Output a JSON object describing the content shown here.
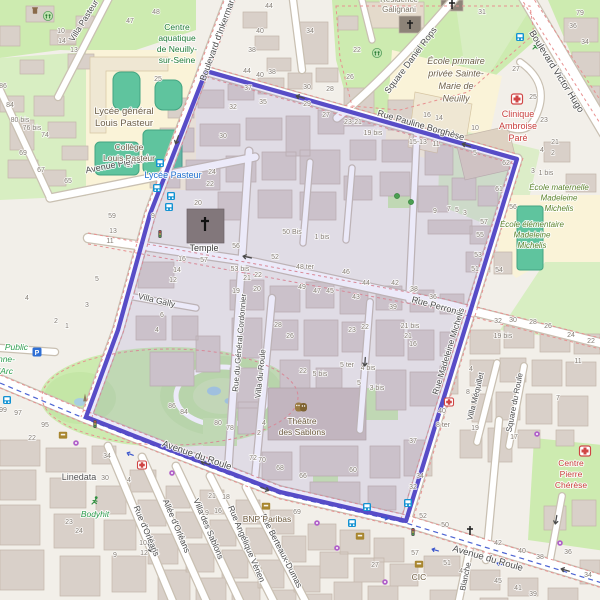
{
  "colors": {
    "boundary": "#4f43c4",
    "boundary_fill": "#6a5ad0",
    "road": "#ffffff",
    "park_green": "#cdebb0",
    "building": "#d9d0c9",
    "pitch_teal": "#5fc49e",
    "hospital_text": "#c9403e",
    "transit_text": "#1f6fd0"
  },
  "streets": [
    {
      "name": "Villa Pasteur",
      "x": 86,
      "y": 22,
      "rot": -58,
      "size": 8.5
    },
    {
      "name": "Boulevard d'Inkermann",
      "x": 221,
      "y": 38,
      "rot": -70,
      "size": 9
    },
    {
      "name": "Avenue Pierrard",
      "x": 118,
      "y": 167,
      "rot": -11,
      "size": 9
    },
    {
      "name": "Rue Pauline Borghèse",
      "x": 420,
      "y": 128,
      "rot": 16,
      "size": 9
    },
    {
      "name": "Square Daniel Rops",
      "x": 413,
      "y": 62,
      "rot": -53,
      "size": 9
    },
    {
      "name": "Boulevard Victor Hugo",
      "x": 554,
      "y": 73,
      "rot": 58,
      "size": 9.5
    },
    {
      "name": "Villa Gally",
      "x": 156,
      "y": 303,
      "rot": 13,
      "size": 8.5
    },
    {
      "name": "Rue du Général Cordonnier",
      "x": 242,
      "y": 343,
      "rot": -85,
      "size": 8
    },
    {
      "name": "Villa du Roule",
      "x": 263,
      "y": 374,
      "rot": -84,
      "size": 8
    },
    {
      "name": "Rue Perronet",
      "x": 437,
      "y": 309,
      "rot": 15,
      "size": 9
    },
    {
      "name": "Rue Madeleine Michelis",
      "x": 451,
      "y": 352,
      "rot": -73,
      "size": 8.5
    },
    {
      "name": "Villa Méquillet",
      "x": 478,
      "y": 397,
      "rot": -76,
      "size": 8
    },
    {
      "name": "Square du Roule",
      "x": 517,
      "y": 403,
      "rot": -79,
      "size": 8
    },
    {
      "name": "Avenue du Roule",
      "x": 196,
      "y": 458,
      "rot": 19,
      "size": 9.5
    },
    {
      "name": "Avenue du Roule",
      "x": 487,
      "y": 561,
      "rot": 16,
      "size": 9.5
    },
    {
      "name": "Rue d'Orléans",
      "x": 144,
      "y": 532,
      "rot": 67,
      "size": 8.5
    },
    {
      "name": "Allée d'Orléans",
      "x": 174,
      "y": 527,
      "rot": 67,
      "size": 8.5
    },
    {
      "name": "Villa des Sablons",
      "x": 206,
      "y": 530,
      "rot": 67,
      "size": 8.5
    },
    {
      "name": "Rue Angélique Vérien",
      "x": 244,
      "y": 545,
      "rot": 67,
      "size": 8.5
    },
    {
      "name": "Rue Berteaux-Dumas",
      "x": 279,
      "y": 552,
      "rot": 63,
      "size": 8.5
    },
    {
      "name": "Blanche",
      "x": 468,
      "y": 577,
      "rot": -78,
      "size": 8
    }
  ],
  "transit_labels": [
    {
      "label": "Lycée Pasteur",
      "x": 173,
      "y": 178
    }
  ],
  "pois": [
    {
      "cls": "park",
      "x": 177,
      "y": 30,
      "lh": 11,
      "size": 8.5,
      "lines": [
        "Centre",
        "aquatique",
        "de Neuilly-",
        "sur-Seine"
      ]
    },
    {
      "cls": "school-dark",
      "x": 124,
      "y": 114,
      "lh": 12,
      "size": 9.5,
      "lines": [
        "Lycée général",
        "Louis Pasteur"
      ]
    },
    {
      "cls": "school-dark",
      "x": 129,
      "y": 150,
      "lh": 11,
      "size": 8.5,
      "lines": [
        "Collège",
        "Louis Pasteur"
      ]
    },
    {
      "cls": "resid",
      "x": 399,
      "y": 2,
      "lh": 10,
      "size": 8,
      "lines": [
        "Résidence",
        "Galignani"
      ]
    },
    {
      "cls": "school-it",
      "x": 456,
      "y": 64,
      "lh": 12.5,
      "size": 9,
      "lines": [
        "École primaire",
        "privée Sainte-",
        "Marie de",
        "Neuilly"
      ]
    },
    {
      "cls": "hospital",
      "x": 518,
      "y": 117,
      "lh": 12,
      "size": 9,
      "lines": [
        "Clinique",
        "Ambroise",
        "Paré"
      ]
    },
    {
      "cls": "school-green",
      "x": 559,
      "y": 190,
      "lh": 10.5,
      "size": 8,
      "lines": [
        "École maternelle",
        "Madeleine",
        "Michelis"
      ]
    },
    {
      "cls": "school-green",
      "x": 532,
      "y": 227,
      "lh": 10.5,
      "size": 8,
      "lines": [
        "École élémentaire",
        "Madeleine",
        "Michelis"
      ]
    },
    {
      "cls": "dark",
      "x": 204,
      "y": 251,
      "size": 9,
      "lines": [
        "Temple"
      ]
    },
    {
      "cls": "company",
      "x": 79,
      "y": 480,
      "size": 9,
      "lines": [
        "Linedata"
      ]
    },
    {
      "cls": "park-it",
      "x": 95,
      "y": 517,
      "size": 8.5,
      "lines": [
        "Bodyhit"
      ]
    },
    {
      "cls": "culture",
      "x": 302,
      "y": 424,
      "lh": 11,
      "size": 8.5,
      "lines": [
        "Théâtre",
        "des Sablons"
      ]
    },
    {
      "cls": "bank-label",
      "x": 267,
      "y": 522,
      "size": 8.5,
      "lines": [
        "BNP Paribas"
      ]
    },
    {
      "cls": "bank-label",
      "x": 419,
      "y": 580,
      "size": 8.5,
      "lines": [
        "CIC"
      ]
    },
    {
      "cls": "hospital",
      "x": 571,
      "y": 466,
      "lh": 11,
      "size": 8.5,
      "lines": [
        "Centre",
        "Pierre",
        "Chérèse"
      ]
    },
    {
      "cls": "park-it",
      "x": 28,
      "y": 350,
      "size": 8.5,
      "anchor": "end",
      "lines": [
        "Public"
      ]
    },
    {
      "cls": "park-it",
      "x": 15,
      "y": 362,
      "size": 8.5,
      "anchor": "end",
      "lines": [
        "anne-"
      ]
    },
    {
      "cls": "park-it",
      "x": 13,
      "y": 374,
      "size": 8.5,
      "anchor": "end",
      "lines": [
        "'Arc"
      ]
    }
  ],
  "house_numbers": [
    [
      61,
      33,
      "10"
    ],
    [
      62,
      43,
      "14"
    ],
    [
      74,
      52,
      "13"
    ],
    [
      156,
      14,
      "48"
    ],
    [
      130,
      23,
      "47"
    ],
    [
      158,
      81,
      "25"
    ],
    [
      3,
      88,
      "86"
    ],
    [
      10,
      107,
      "84"
    ],
    [
      20,
      122,
      "80 bis"
    ],
    [
      32,
      130,
      "76 bis"
    ],
    [
      45,
      137,
      "74"
    ],
    [
      23,
      155,
      "69"
    ],
    [
      41,
      172,
      "67"
    ],
    [
      68,
      183,
      "65"
    ],
    [
      130,
      167,
      "17"
    ],
    [
      153,
      218,
      "9"
    ],
    [
      269,
      8,
      "44"
    ],
    [
      260,
      33,
      "40"
    ],
    [
      252,
      52,
      "38"
    ],
    [
      310,
      33,
      "34"
    ],
    [
      357,
      52,
      "22"
    ],
    [
      350,
      79,
      "26"
    ],
    [
      247,
      73,
      "44"
    ],
    [
      260,
      77,
      "40"
    ],
    [
      272,
      74,
      "38"
    ],
    [
      307,
      89,
      "30"
    ],
    [
      330,
      91,
      "28"
    ],
    [
      248,
      90,
      "37"
    ],
    [
      263,
      104,
      "35"
    ],
    [
      233,
      109,
      "32"
    ],
    [
      307,
      106,
      "29"
    ],
    [
      326,
      117,
      "27"
    ],
    [
      353,
      124,
      "23-21"
    ],
    [
      373,
      135,
      "19 bis"
    ],
    [
      223,
      138,
      "30"
    ],
    [
      212,
      174,
      "24"
    ],
    [
      210,
      186,
      "22"
    ],
    [
      482,
      14,
      "31"
    ],
    [
      516,
      71,
      "27"
    ],
    [
      533,
      99,
      "25"
    ],
    [
      544,
      122,
      "23"
    ],
    [
      555,
      144,
      "21"
    ],
    [
      580,
      15,
      "79"
    ],
    [
      573,
      28,
      "36"
    ],
    [
      585,
      44,
      "34"
    ],
    [
      427,
      117,
      "16"
    ],
    [
      439,
      120,
      "14"
    ],
    [
      475,
      130,
      "10"
    ],
    [
      418,
      144,
      "15-13"
    ],
    [
      436,
      146,
      "11"
    ],
    [
      475,
      155,
      "5"
    ],
    [
      542,
      152,
      "4"
    ],
    [
      553,
      155,
      "2"
    ],
    [
      533,
      173,
      "3"
    ],
    [
      546,
      175,
      "1 bis"
    ],
    [
      506,
      165,
      "62"
    ],
    [
      499,
      191,
      "61"
    ],
    [
      112,
      218,
      "59"
    ],
    [
      113,
      233,
      "13"
    ],
    [
      110,
      243,
      "11"
    ],
    [
      97,
      281,
      "5"
    ],
    [
      27,
      300,
      "4"
    ],
    [
      87,
      307,
      "3"
    ],
    [
      56,
      323,
      "2"
    ],
    [
      67,
      328,
      "1"
    ],
    [
      182,
      261,
      "16"
    ],
    [
      177,
      272,
      "14"
    ],
    [
      173,
      282,
      "12"
    ],
    [
      162,
      317,
      "6"
    ],
    [
      157,
      332,
      "4"
    ],
    [
      198,
      205,
      "20"
    ],
    [
      292,
      234,
      "50 Bis"
    ],
    [
      322,
      239,
      "1 bis"
    ],
    [
      236,
      248,
      "56"
    ],
    [
      275,
      259,
      "52"
    ],
    [
      204,
      262,
      "57"
    ],
    [
      240,
      271,
      "53 bis"
    ],
    [
      258,
      277,
      "22"
    ],
    [
      247,
      280,
      "21"
    ],
    [
      257,
      291,
      "20"
    ],
    [
      236,
      293,
      "19"
    ],
    [
      305,
      269,
      "48 ter"
    ],
    [
      346,
      274,
      "46"
    ],
    [
      366,
      285,
      "44"
    ],
    [
      395,
      285,
      "42"
    ],
    [
      413,
      292,
      "38"
    ],
    [
      302,
      289,
      "49"
    ],
    [
      317,
      293,
      "47"
    ],
    [
      330,
      293,
      "45"
    ],
    [
      356,
      299,
      "43"
    ],
    [
      393,
      309,
      "39"
    ],
    [
      352,
      332,
      "23"
    ],
    [
      365,
      329,
      "22"
    ],
    [
      410,
      328,
      "21 bis"
    ],
    [
      408,
      338,
      "21"
    ],
    [
      413,
      346,
      "16"
    ],
    [
      278,
      327,
      "28"
    ],
    [
      290,
      338,
      "26"
    ],
    [
      347,
      367,
      "5 ter"
    ],
    [
      368,
      370,
      "4 bis"
    ],
    [
      320,
      376,
      "5 bis"
    ],
    [
      303,
      373,
      "22"
    ],
    [
      359,
      385,
      "5"
    ],
    [
      377,
      390,
      "3 bis"
    ],
    [
      513,
      209,
      "56"
    ],
    [
      499,
      272,
      "54"
    ],
    [
      484,
      224,
      "57"
    ],
    [
      480,
      237,
      "55"
    ],
    [
      478,
      257,
      "53"
    ],
    [
      475,
      271,
      "51"
    ],
    [
      414,
      291,
      "38"
    ],
    [
      433,
      299,
      "36"
    ],
    [
      435,
      213,
      "9"
    ],
    [
      449,
      211,
      "7"
    ],
    [
      457,
      212,
      "5"
    ],
    [
      465,
      215,
      "3"
    ],
    [
      498,
      323,
      "32"
    ],
    [
      513,
      322,
      "30"
    ],
    [
      533,
      324,
      "28"
    ],
    [
      548,
      328,
      "26"
    ],
    [
      571,
      337,
      "24"
    ],
    [
      591,
      343,
      "22"
    ],
    [
      503,
      338,
      "19 bis"
    ],
    [
      578,
      363,
      "11"
    ],
    [
      471,
      371,
      "4"
    ],
    [
      468,
      394,
      "8"
    ],
    [
      3,
      412,
      "99"
    ],
    [
      18,
      415,
      "97"
    ],
    [
      45,
      427,
      "95"
    ],
    [
      32,
      440,
      "22"
    ],
    [
      107,
      458,
      "34"
    ],
    [
      105,
      480,
      "30"
    ],
    [
      129,
      482,
      "4"
    ],
    [
      69,
      524,
      "23"
    ],
    [
      79,
      533,
      "24"
    ],
    [
      115,
      557,
      "9"
    ],
    [
      143,
      545,
      "10"
    ],
    [
      144,
      555,
      "12"
    ],
    [
      156,
      554,
      "11"
    ],
    [
      172,
      408,
      "86"
    ],
    [
      184,
      414,
      "84"
    ],
    [
      218,
      425,
      "80"
    ],
    [
      230,
      430,
      "78"
    ],
    [
      264,
      425,
      "4"
    ],
    [
      259,
      435,
      "2"
    ],
    [
      253,
      460,
      "72"
    ],
    [
      262,
      462,
      "70"
    ],
    [
      280,
      470,
      "68"
    ],
    [
      303,
      478,
      "66"
    ],
    [
      353,
      472,
      "60"
    ],
    [
      297,
      514,
      "69"
    ],
    [
      212,
      498,
      "21"
    ],
    [
      226,
      499,
      "18"
    ],
    [
      205,
      515,
      "19"
    ],
    [
      218,
      513,
      "16"
    ],
    [
      375,
      567,
      "27"
    ],
    [
      442,
      413,
      "40"
    ],
    [
      443,
      427,
      "8 ter"
    ],
    [
      475,
      430,
      "19"
    ],
    [
      514,
      439,
      "17"
    ],
    [
      558,
      400,
      "7"
    ],
    [
      413,
      443,
      "37"
    ],
    [
      420,
      478,
      "34"
    ],
    [
      413,
      489,
      "32"
    ],
    [
      423,
      518,
      "52"
    ],
    [
      445,
      527,
      "50"
    ],
    [
      498,
      545,
      "42"
    ],
    [
      522,
      553,
      "40"
    ],
    [
      540,
      559,
      "38"
    ],
    [
      568,
      554,
      "36"
    ],
    [
      588,
      577,
      "34"
    ],
    [
      415,
      555,
      "57"
    ],
    [
      447,
      565,
      "51"
    ],
    [
      463,
      573,
      "49"
    ],
    [
      498,
      583,
      "45"
    ],
    [
      518,
      590,
      "41"
    ],
    [
      533,
      596,
      "39"
    ]
  ],
  "icons": [
    {
      "type": "waste",
      "x": 35,
      "y": 11
    },
    {
      "type": "playground",
      "x": 48,
      "y": 16
    },
    {
      "type": "playground",
      "x": 377,
      "y": 53
    },
    {
      "type": "runner",
      "x": 536,
      "y": 46
    },
    {
      "type": "runner",
      "x": 95,
      "y": 501
    },
    {
      "type": "bus",
      "x": 160,
      "y": 163
    },
    {
      "type": "bus",
      "x": 157,
      "y": 188
    },
    {
      "type": "bus",
      "x": 171,
      "y": 196
    },
    {
      "type": "bus",
      "x": 169,
      "y": 207
    },
    {
      "type": "bus",
      "x": 520,
      "y": 37
    },
    {
      "type": "bus",
      "x": 7,
      "y": 400
    },
    {
      "type": "bus",
      "x": 367,
      "y": 507
    },
    {
      "type": "bus",
      "x": 408,
      "y": 503
    },
    {
      "type": "bus",
      "x": 352,
      "y": 523
    },
    {
      "type": "traffic",
      "x": 160,
      "y": 234
    },
    {
      "type": "traffic",
      "x": 413,
      "y": 532
    },
    {
      "type": "traffic",
      "x": 95,
      "y": 424
    },
    {
      "type": "hospital",
      "x": 517,
      "y": 99
    },
    {
      "type": "hospital",
      "x": 585,
      "y": 451
    },
    {
      "type": "pharmacy",
      "x": 142,
      "y": 465
    },
    {
      "type": "pharmacy",
      "x": 449,
      "y": 402
    },
    {
      "type": "cross",
      "x": 410,
      "y": 25
    },
    {
      "type": "cross",
      "x": 452,
      "y": 5
    },
    {
      "type": "cross",
      "x": 470,
      "y": 531
    },
    {
      "type": "crossbig",
      "x": 205,
      "y": 224
    },
    {
      "type": "bank",
      "x": 63,
      "y": 435
    },
    {
      "type": "bank",
      "x": 266,
      "y": 506
    },
    {
      "type": "bank",
      "x": 419,
      "y": 564
    },
    {
      "type": "bank",
      "x": 360,
      "y": 536
    },
    {
      "type": "shop",
      "x": 172,
      "y": 473
    },
    {
      "type": "shop",
      "x": 317,
      "y": 523
    },
    {
      "type": "shop",
      "x": 337,
      "y": 548
    },
    {
      "type": "shop",
      "x": 385,
      "y": 582
    },
    {
      "type": "shop",
      "x": 537,
      "y": 434
    },
    {
      "type": "shop",
      "x": 560,
      "y": 543
    },
    {
      "type": "shop",
      "x": 76,
      "y": 443
    },
    {
      "type": "monument",
      "x": 85,
      "y": 398
    },
    {
      "type": "parking",
      "x": 37,
      "y": 352,
      "glyph": "P"
    },
    {
      "type": "tree",
      "x": 397,
      "y": 196
    },
    {
      "type": "tree",
      "x": 411,
      "y": 202
    },
    {
      "type": "theater",
      "x": 301,
      "y": 407
    },
    {
      "type": "arrow",
      "x": 300,
      "y": 97,
      "rot": 196
    },
    {
      "type": "arrow",
      "x": 466,
      "y": 145,
      "rot": 196
    },
    {
      "type": "arrow",
      "x": 247,
      "y": 257,
      "rot": 192
    },
    {
      "type": "arrow",
      "x": 420,
      "y": 300,
      "rot": 192
    },
    {
      "type": "arrow",
      "x": 205,
      "y": 463,
      "rot": 201
    },
    {
      "type": "arrow",
      "x": 265,
      "y": 489,
      "rot": 21
    },
    {
      "type": "arrow",
      "x": 565,
      "y": 570,
      "rot": 196
    },
    {
      "type": "arrow",
      "x": 365,
      "y": 362,
      "rot": 94
    },
    {
      "type": "arrow",
      "x": 150,
      "y": 548,
      "rot": 67
    },
    {
      "type": "arrow",
      "x": 177,
      "y": 140,
      "rot": 110
    },
    {
      "type": "arrow",
      "x": 556,
      "y": 520,
      "rot": 100
    },
    {
      "type": "barrow",
      "x": 130,
      "y": 454,
      "rot": 201
    },
    {
      "type": "barrow",
      "x": 435,
      "y": 550,
      "rot": 196
    },
    {
      "type": "barrow",
      "x": 500,
      "y": 564,
      "rot": 196
    },
    {
      "type": "barrow",
      "x": 385,
      "y": 518,
      "rot": 16
    }
  ]
}
